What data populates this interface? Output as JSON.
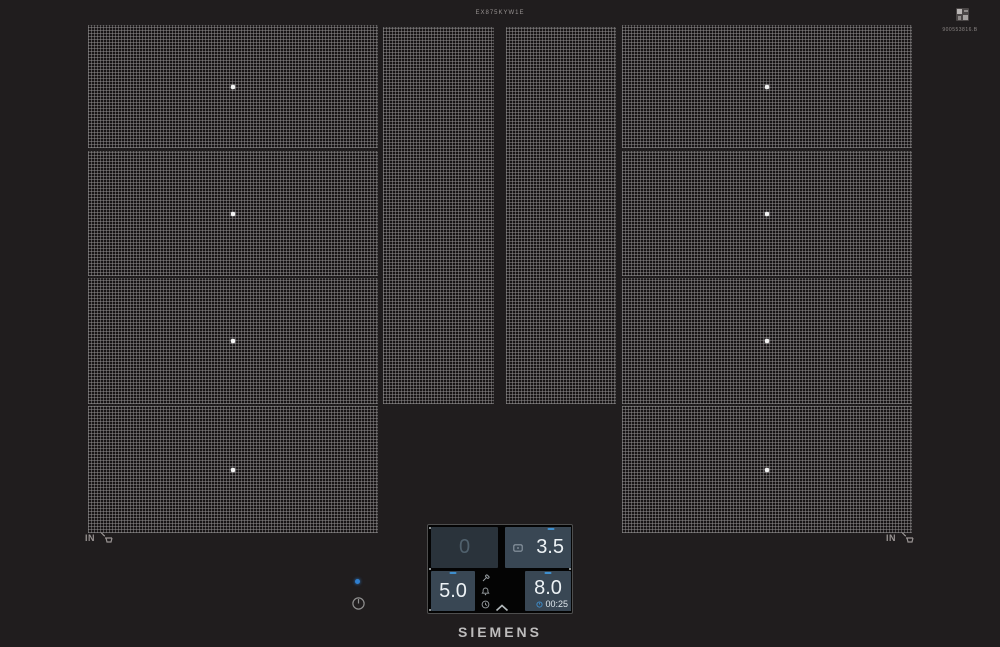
{
  "branding": {
    "logo_text": "SIEMENS",
    "model_code": "EX875KYW1E",
    "certificate_code": "900553816.B"
  },
  "surface": {
    "left_in_label": "IN",
    "right_in_label": "IN",
    "zones": {
      "left_flex_sections": 4,
      "middle_vertical_sections": 2,
      "right_flex_sections": 4
    }
  },
  "control_panel": {
    "zone_top_left": {
      "value": "0",
      "state": "inactive"
    },
    "zone_top_right": {
      "value": "3.5",
      "icon": "pan-indicator-icon"
    },
    "zone_bottom_left": {
      "value": "5.0"
    },
    "zone_bottom_right": {
      "value": "8.0",
      "timer": "00:25"
    },
    "menu_icons": [
      "wrench-icon",
      "bell-icon",
      "clock-icon"
    ],
    "chevron": "expand-up"
  },
  "colors": {
    "accent_blue": "#3f8fce",
    "led_blue": "#2f7fd0",
    "tile_active_bg": "#394754",
    "tile_inactive_bg": "#2a333b",
    "inactive_value": "#50616d"
  }
}
